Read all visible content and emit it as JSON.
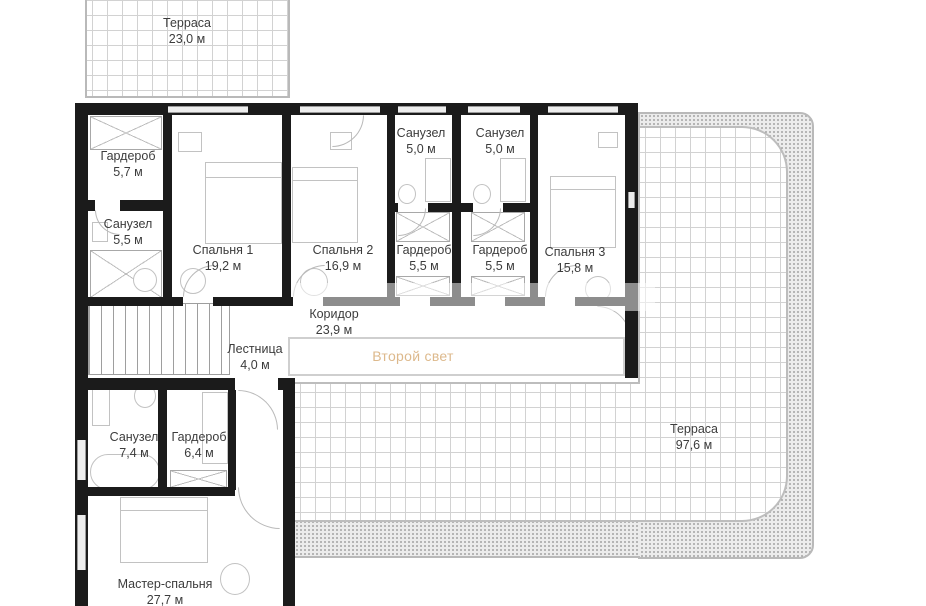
{
  "rooms": {
    "terrace_top": {
      "name": "Терраса",
      "area": "23,0 м"
    },
    "wardrobe_1": {
      "name": "Гардероб",
      "area": "5,7 м"
    },
    "bath_1": {
      "name": "Санузел",
      "area": "5,5 м"
    },
    "bedroom_1": {
      "name": "Спальня 1",
      "area": "19,2 м"
    },
    "bedroom_2": {
      "name": "Спальня 2",
      "area": "16,9 м"
    },
    "bath_2": {
      "name": "Санузел",
      "area": "5,0 м"
    },
    "bath_3": {
      "name": "Санузел",
      "area": "5,0 м"
    },
    "wardrobe_2": {
      "name": "Гардероб",
      "area": "5,5 м"
    },
    "wardrobe_3": {
      "name": "Гардероб",
      "area": "5,5 м"
    },
    "bedroom_3": {
      "name": "Спальня 3",
      "area": "15,8 м"
    },
    "corridor": {
      "name": "Коридор",
      "area": "23,9 м"
    },
    "stairs": {
      "name": "Лестница",
      "area": "4,0 м"
    },
    "second_light": {
      "name": "Второй свет"
    },
    "bath_4": {
      "name": "Санузел",
      "area": "7,4 м"
    },
    "wardrobe_4": {
      "name": "Гардероб",
      "area": "6,4 м"
    },
    "master_bedroom": {
      "name": "Мастер-спальня",
      "area": "27,7 м"
    },
    "terrace_right": {
      "name": "Терраса",
      "area": "97,6 м"
    }
  },
  "colors": {
    "wall": "#1b1b1b",
    "grid_line": "#d2d2d2",
    "terrace_border": "#b9b9b9",
    "accent_text": "#ddb98c",
    "label_text": "#3c3c3c"
  }
}
